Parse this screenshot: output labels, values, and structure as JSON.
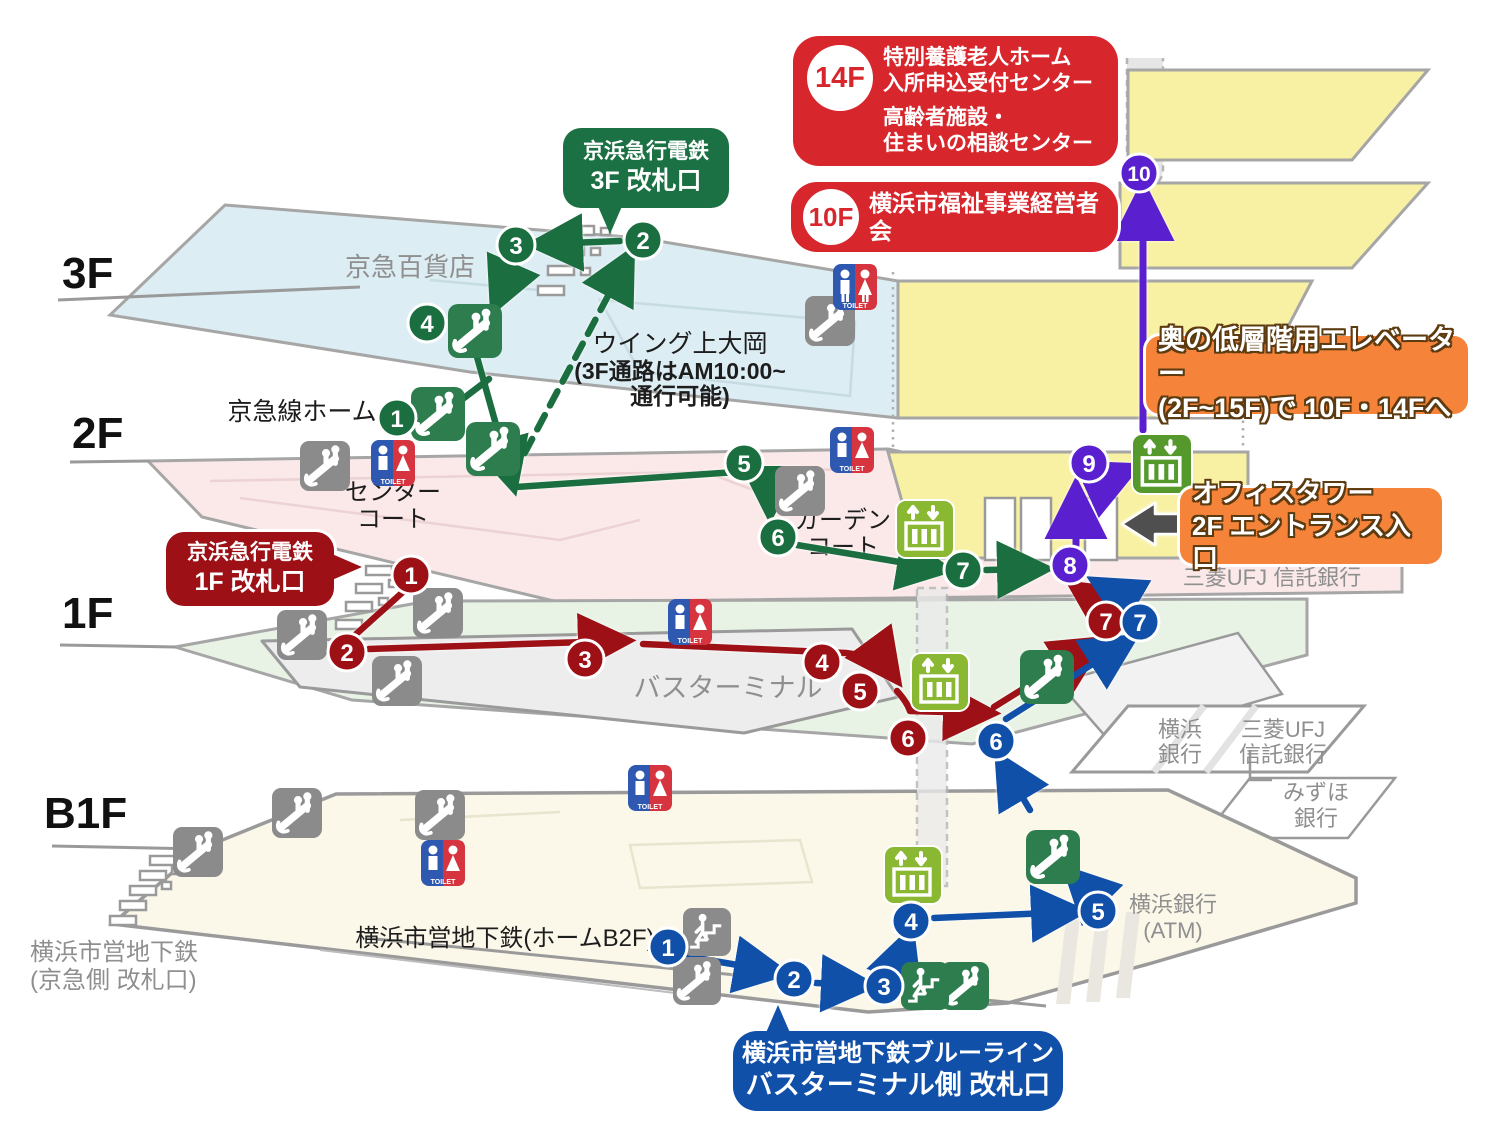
{
  "banners": {
    "care_center": {
      "floor_badge": "14F",
      "line1": "特別養護老人ホーム",
      "line2": "入所申込受付センター",
      "line3": "高齢者施設・",
      "line4": "住まいの相談センター"
    },
    "business_assoc": {
      "floor_badge": "10F",
      "text": "横浜市福祉事業経営者会"
    },
    "keikyu_3f_gate": {
      "line1": "京浜急行電鉄",
      "line2": "3F 改札口"
    },
    "keikyu_1f_gate": {
      "line1": "京浜急行電鉄",
      "line2": "1F 改札口"
    },
    "subway_gate": {
      "line1": "横浜市営地下鉄ブルーライン",
      "line2": "バスターミナル側 改札口"
    },
    "elevator_note": {
      "line1": "奥の低層階用エレベーター",
      "line2": "(2F~15F)で 10F・14Fへ"
    },
    "office_entrance": {
      "line1": "オフィスタワー",
      "line2": "2F エントランス入口"
    }
  },
  "floor_labels": {
    "f3": "3F",
    "f2": "2F",
    "f1": "1F",
    "b1": "B1F"
  },
  "map_labels": {
    "keikyu_dept": "京急百貨店",
    "wing1": "ウイング上大岡",
    "wing2": "(3F通路はAM10:00~",
    "wing3": "通行可能)",
    "keikyu_home": "京急線ホーム",
    "center1": "センター",
    "center2": "コート",
    "garden1": "ガーデン",
    "garden2": "コート",
    "bus_terminal": "バスターミナル",
    "mufg_2f": "三菱UFJ 信託銀行",
    "yokohama_bk1": "横浜",
    "yokohama_bk2": "銀行",
    "mufg1": "三菱UFJ",
    "mufg2": "信託銀行",
    "mizuho1": "みずほ",
    "mizuho2": "銀行",
    "yokohama_atm1": "横浜銀行",
    "yokohama_atm2": "(ATM)",
    "subway_b2f": "横浜市営地下鉄(ホームB2F)",
    "subway_keikyu1": "横浜市営地下鉄",
    "subway_keikyu2": "(京急側 改札口)"
  },
  "routes": {
    "green_stops": [
      "1",
      "2",
      "3",
      "4",
      "5",
      "6",
      "7"
    ],
    "red_stops": [
      "1",
      "2",
      "3",
      "4",
      "5",
      "6",
      "7"
    ],
    "blue_stops": [
      "1",
      "2",
      "3",
      "4",
      "5",
      "6",
      "7"
    ],
    "purple_stops": [
      "8",
      "9",
      "10"
    ]
  },
  "icons": {
    "toilet_label": "TOILET"
  },
  "colors": {
    "green_route": "#1b6e40",
    "red_route": "#9c1016",
    "blue_route": "#1150a9",
    "purple_route": "#5a20cf",
    "banner_red": "#d7272d",
    "banner_orange": "#f5833a",
    "bubble_green": "#1c7144",
    "floor_yellow": "#f8f1a3",
    "floor_blue": "#dcedf3",
    "floor_pink": "#fbe9e9",
    "floor_green": "#e8f3e5",
    "floor_cream": "#fbf8e9"
  }
}
